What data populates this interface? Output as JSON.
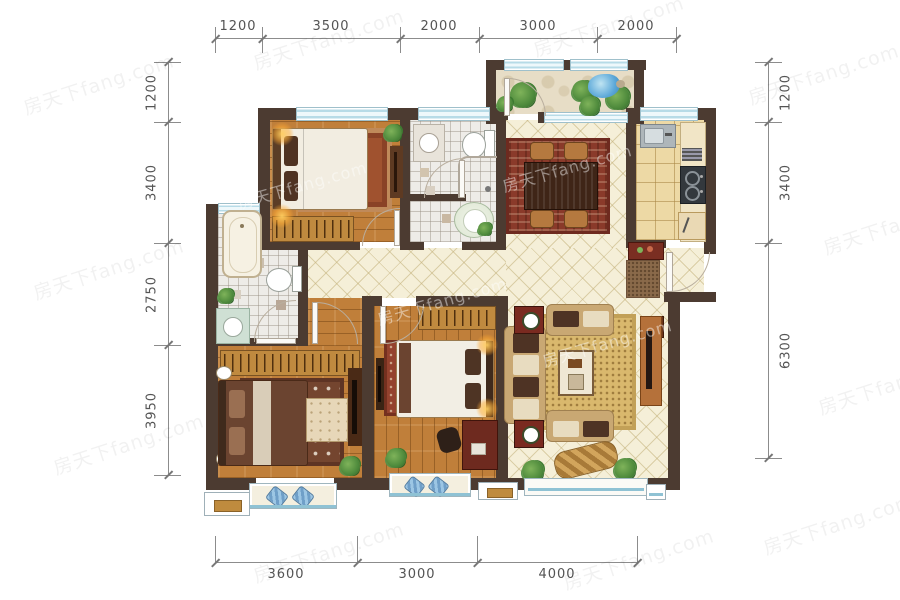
{
  "watermark": {
    "text": "房天下fang.com"
  },
  "dimensions": {
    "top": [
      "1200",
      "3500",
      "2000",
      "3000",
      "2000"
    ],
    "bottom": [
      "3600",
      "3000",
      "4000"
    ],
    "left": [
      "1200",
      "3400",
      "2750",
      "3950"
    ],
    "right": [
      "1200",
      "3400",
      "6300"
    ]
  },
  "colors": {
    "wall": "#4c3b31",
    "wood_floor": "#c07f3a",
    "tile_floor": "#f5efd8",
    "kitchen_tile": "#edd9a5",
    "bath_tile": "#eeece8",
    "window_glass": "#b7dbe7",
    "dimension_text": "#545454",
    "dining_rug": "#8a3a2a",
    "living_rug": "#d9b86d",
    "sofa": "#c9a873"
  }
}
